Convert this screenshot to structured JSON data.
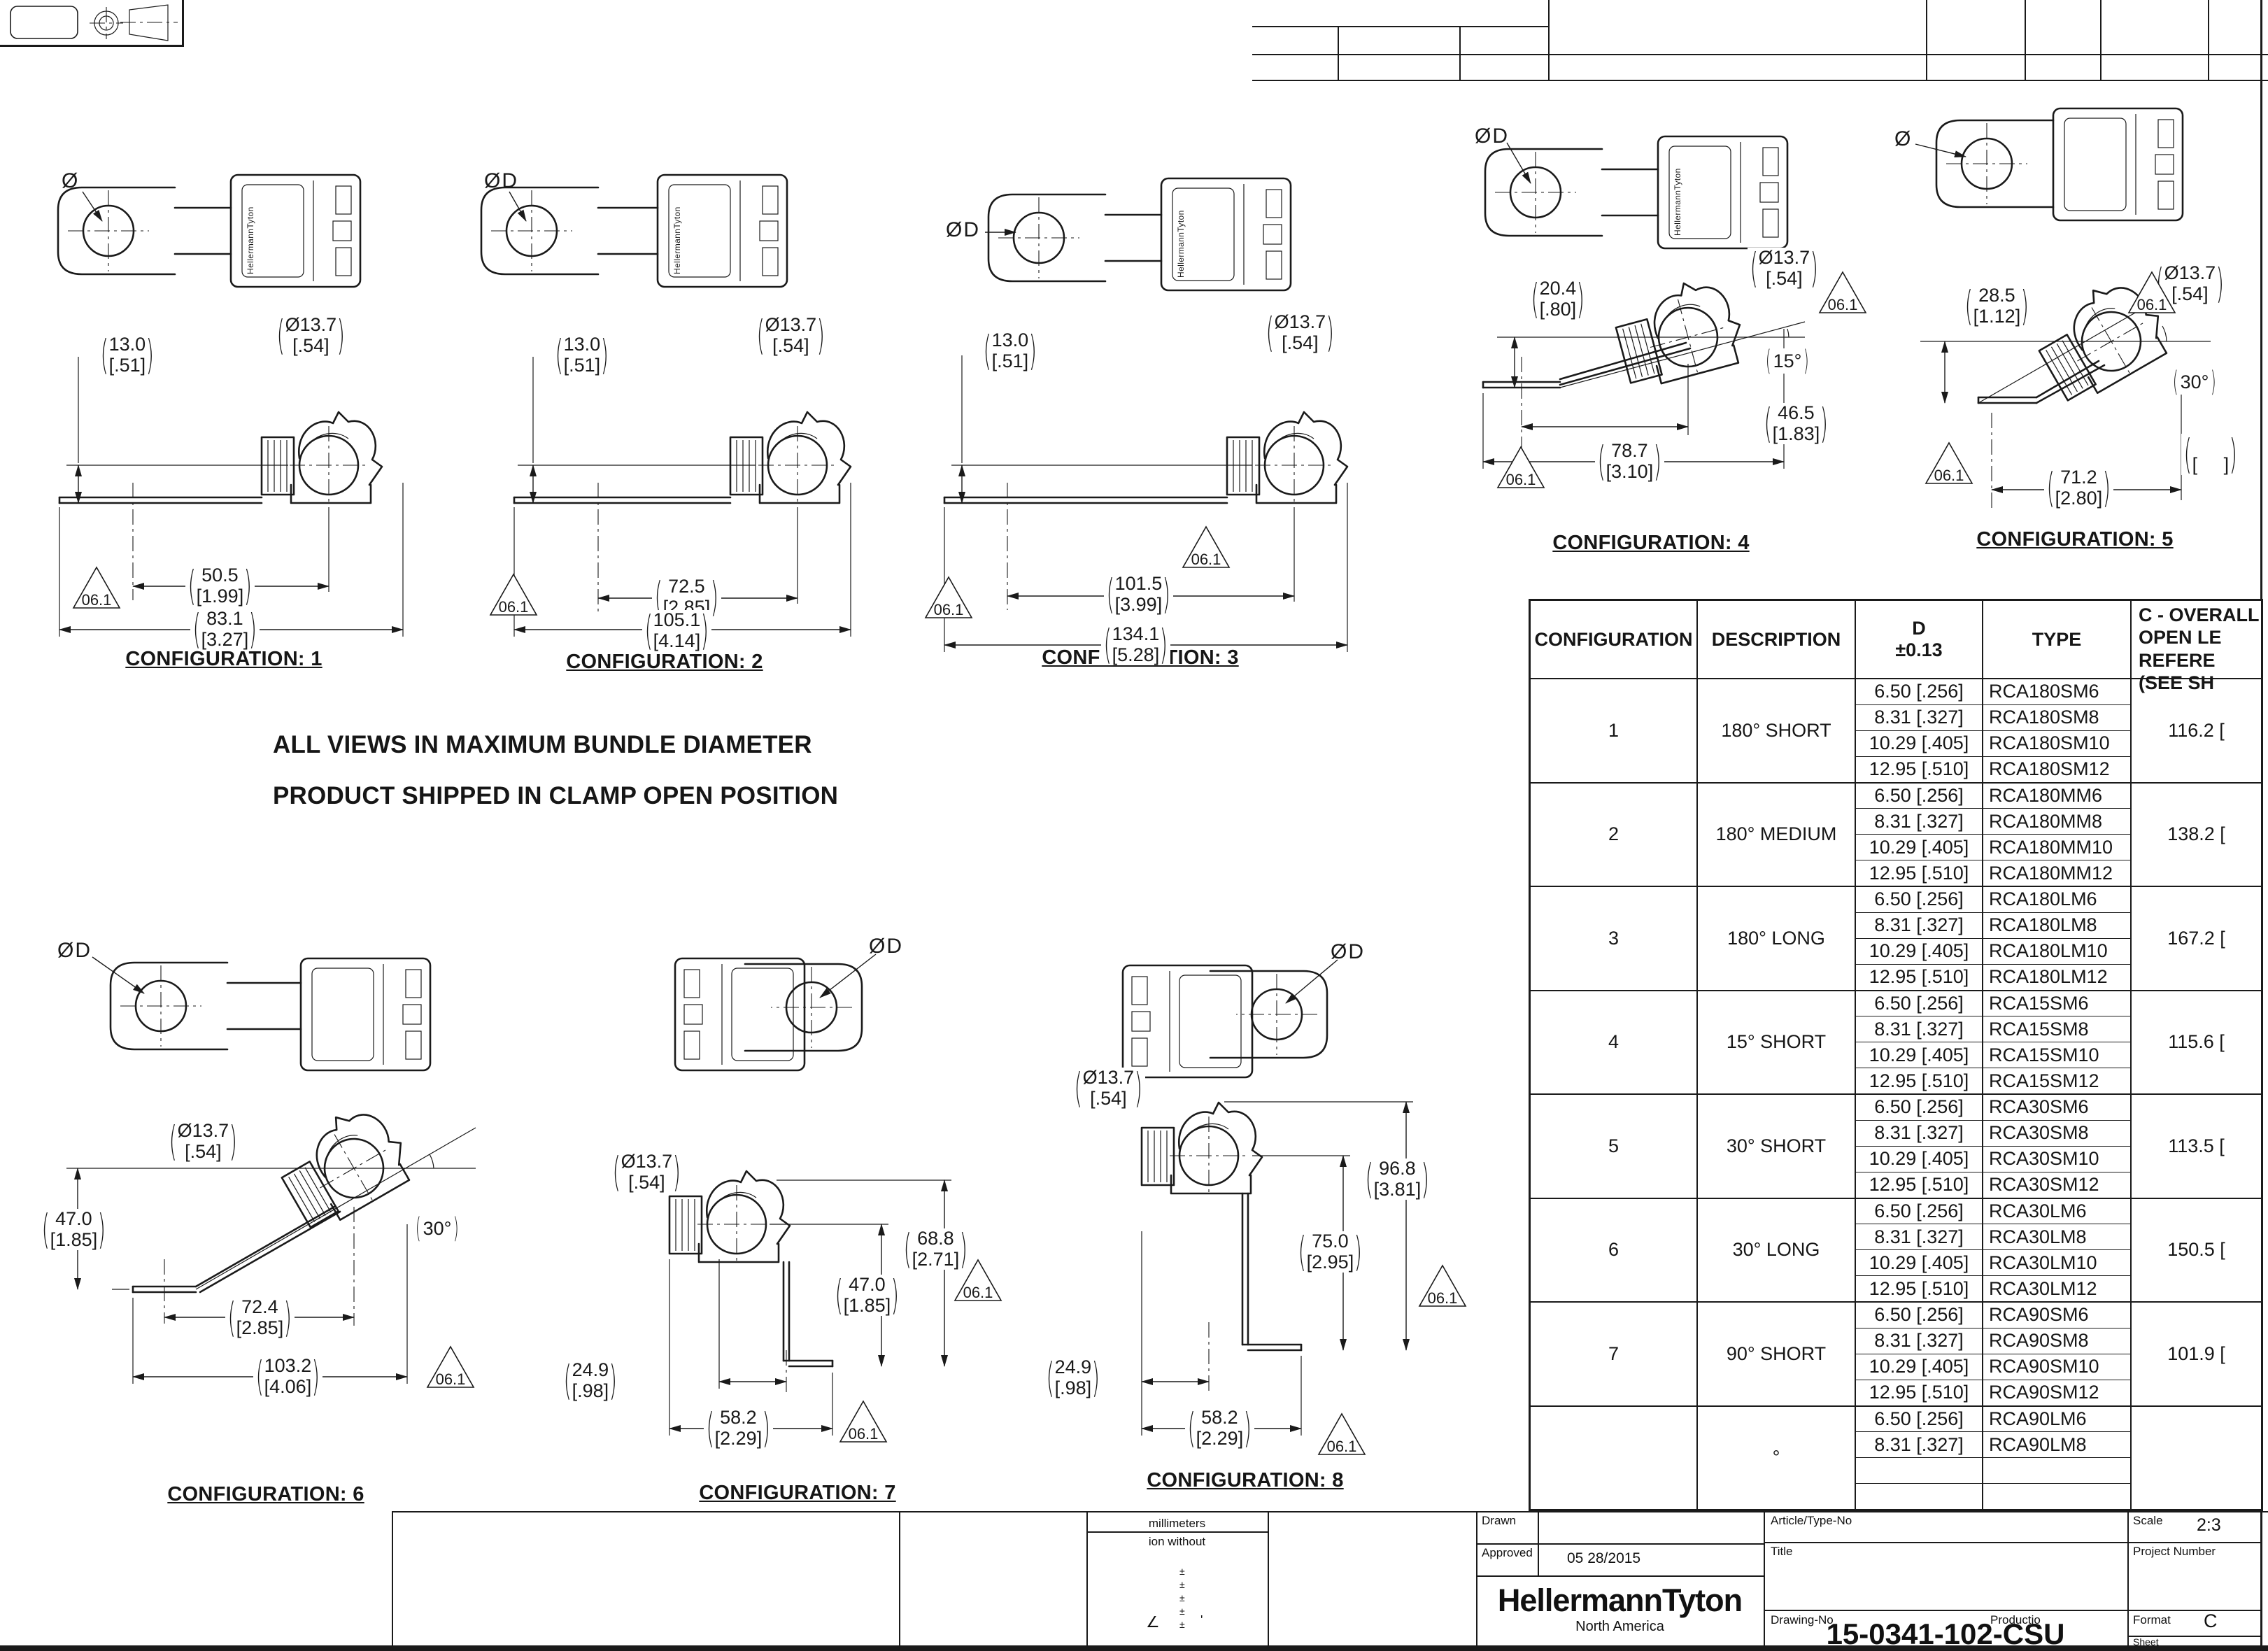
{
  "brand": "HellermannTyton",
  "datum": "06.1",
  "notes": {
    "line1": "ALL VIEWS IN MAXIMUM BUNDLE DIAMETER",
    "line2": "PRODUCT SHIPPED IN CLAMP OPEN POSITION"
  },
  "configs": [
    {
      "title": "CONFIGURATION: 1",
      "hole": "Ø",
      "dims": {
        "h_mm": "13.0",
        "h_in": "[.51]",
        "dia_mm": "Ø13.7",
        "dia_in": "[.54]",
        "a_mm": "50.5",
        "a_in": "[1.99]",
        "b_mm": "83.1",
        "b_in": "[3.27]"
      }
    },
    {
      "title": "CONFIGURATION: 2",
      "hole": "ØD",
      "dims": {
        "h_mm": "13.0",
        "h_in": "[.51]",
        "dia_mm": "Ø13.7",
        "dia_in": "[.54]",
        "a_mm": "72.5",
        "a_in": "[2.85]",
        "b_mm": "105.1",
        "b_in": "[4.14]"
      }
    },
    {
      "title": "CONFIGURATION: 3",
      "hole": "ØD",
      "dims": {
        "h_mm": "13.0",
        "h_in": "[.51]",
        "dia_mm": "Ø13.7",
        "dia_in": "[.54]",
        "a_mm": "101.5",
        "a_in": "[3.99]",
        "b_mm": "134.1",
        "b_in": "[5.28]"
      }
    },
    {
      "title": "CONFIGURATION: 4",
      "hole": "ØD",
      "dims": {
        "h_mm": "20.4",
        "h_in": "[.80]",
        "dia_mm": "Ø13.7",
        "dia_in": "[.54]",
        "angle": "15°",
        "a_mm": "46.5",
        "a_in": "[1.83]",
        "b_mm": "78.7",
        "b_in": "[3.10]"
      }
    },
    {
      "title": "CONFIGURATION: 5",
      "hole": "Ø",
      "dims": {
        "h_mm": "28.5",
        "h_in": "[1.12]",
        "dia_mm": "Ø13.7",
        "dia_in": "[.54]",
        "angle": "30°",
        "blank_mm": " ",
        "blank_in": "[     ]",
        "b_mm": "71.2",
        "b_in": "[2.80]"
      }
    },
    {
      "title": "CONFIGURATION: 6",
      "hole": "ØD",
      "dims": {
        "h_mm": "47.0",
        "h_in": "[1.85]",
        "dia_mm": "Ø13.7",
        "dia_in": "[.54]",
        "angle": "30°",
        "a_mm": "72.4",
        "a_in": "[2.85]",
        "b_mm": "103.2",
        "b_in": "[4.06]"
      }
    },
    {
      "title": "CONFIGURATION: 7",
      "hole": "ØD",
      "dims": {
        "dia_mm": "Ø13.7",
        "dia_in": "[.54]",
        "v1_mm": "68.8",
        "v1_in": "[2.71]",
        "v2_mm": "47.0",
        "v2_in": "[1.85]",
        "off_mm": "24.9",
        "off_in": "[.98]",
        "a_mm": "58.2",
        "a_in": "[2.29]"
      }
    },
    {
      "title": "CONFIGURATION: 8",
      "hole": "ØD",
      "dims": {
        "dia_mm": "Ø13.7",
        "dia_in": "[.54]",
        "v1_mm": "96.8",
        "v1_in": "[3.81]",
        "v2_mm": "75.0",
        "v2_in": "[2.95]",
        "off_mm": "24.9",
        "off_in": "[.98]",
        "a_mm": "58.2",
        "a_in": "[2.29]"
      }
    }
  ],
  "table": {
    "headers": {
      "config": "CONFIGURATION",
      "desc": "DESCRIPTION",
      "d1": "D",
      "d2": "±0.13",
      "type": "TYPE",
      "c": "C - OVERALL\nOPEN LE\n REFERE\n(SEE SH"
    },
    "groups": [
      {
        "config": "1",
        "desc": "180° SHORT",
        "c": "116.2 [",
        "rows": [
          {
            "d": "6.50 [.256]",
            "t": "RCA180SM6"
          },
          {
            "d": "8.31 [.327]",
            "t": "RCA180SM8"
          },
          {
            "d": "10.29 [.405]",
            "t": "RCA180SM10"
          },
          {
            "d": "12.95 [.510]",
            "t": "RCA180SM12"
          }
        ]
      },
      {
        "config": "2",
        "desc": "180° MEDIUM",
        "c": "138.2 [",
        "rows": [
          {
            "d": "6.50 [.256]",
            "t": "RCA180MM6"
          },
          {
            "d": "8.31 [.327]",
            "t": "RCA180MM8"
          },
          {
            "d": "10.29 [.405]",
            "t": "RCA180MM10"
          },
          {
            "d": "12.95 [.510]",
            "t": "RCA180MM12"
          }
        ]
      },
      {
        "config": "3",
        "desc": "180° LONG",
        "c": "167.2 [",
        "rows": [
          {
            "d": "6.50 [.256]",
            "t": "RCA180LM6"
          },
          {
            "d": "8.31 [.327]",
            "t": "RCA180LM8"
          },
          {
            "d": "10.29 [.405]",
            "t": "RCA180LM10"
          },
          {
            "d": "12.95 [.510]",
            "t": "RCA180LM12"
          }
        ]
      },
      {
        "config": "4",
        "desc": "15° SHORT",
        "c": "115.6 [",
        "rows": [
          {
            "d": "6.50 [.256]",
            "t": "RCA15SM6"
          },
          {
            "d": "8.31 [.327]",
            "t": "RCA15SM8"
          },
          {
            "d": "10.29 [.405]",
            "t": "RCA15SM10"
          },
          {
            "d": "12.95 [.510]",
            "t": "RCA15SM12"
          }
        ]
      },
      {
        "config": "5",
        "desc": "30° SHORT",
        "c": "113.5 [",
        "rows": [
          {
            "d": "6.50 [.256]",
            "t": "RCA30SM6"
          },
          {
            "d": "8.31 [.327]",
            "t": "RCA30SM8"
          },
          {
            "d": "10.29 [.405]",
            "t": "RCA30SM10"
          },
          {
            "d": "12.95 [.510]",
            "t": "RCA30SM12"
          }
        ]
      },
      {
        "config": "6",
        "desc": "30° LONG",
        "c": "150.5 [",
        "rows": [
          {
            "d": "6.50 [.256]",
            "t": "RCA30LM6"
          },
          {
            "d": "8.31 [.327]",
            "t": "RCA30LM8"
          },
          {
            "d": "10.29 [.405]",
            "t": "RCA30LM10"
          },
          {
            "d": "12.95 [.510]",
            "t": "RCA30LM12"
          }
        ]
      },
      {
        "config": "7",
        "desc": "90° SHORT",
        "c": "101.9 [",
        "rows": [
          {
            "d": "6.50 [.256]",
            "t": "RCA90SM6"
          },
          {
            "d": "8.31 [.327]",
            "t": "RCA90SM8"
          },
          {
            "d": "10.29 [.405]",
            "t": "RCA90SM10"
          },
          {
            "d": "12.95 [.510]",
            "t": "RCA90SM12"
          }
        ]
      },
      {
        "config": "",
        "desc": "°",
        "c": "",
        "rows": [
          {
            "d": "6.50 [.256]",
            "t": "RCA90LM6"
          },
          {
            "d": "8.31 [.327]",
            "t": "RCA90LM8"
          },
          {
            "d": "",
            "t": ""
          },
          {
            "d": "",
            "t": ""
          }
        ]
      }
    ]
  },
  "title_block": {
    "units": "millimeters",
    "units2": "ion without",
    "pm": "±",
    "angle_sym": "∠",
    "tick": "'",
    "drawn": "Drawn",
    "approved": "Approved",
    "date": "05 28/2015",
    "logo": "HellermannTyton",
    "logo_sub": "North America",
    "article": "Article/Type-No",
    "title": "Title",
    "drawing": "Drawing-No",
    "production": "Productio",
    "drawing_no": "15-0341-102-CSU",
    "scale_label": "Scale",
    "scale": "2:3",
    "project": "Project Number",
    "format_label": "Format",
    "format": "C",
    "sheet": "Sheet"
  }
}
